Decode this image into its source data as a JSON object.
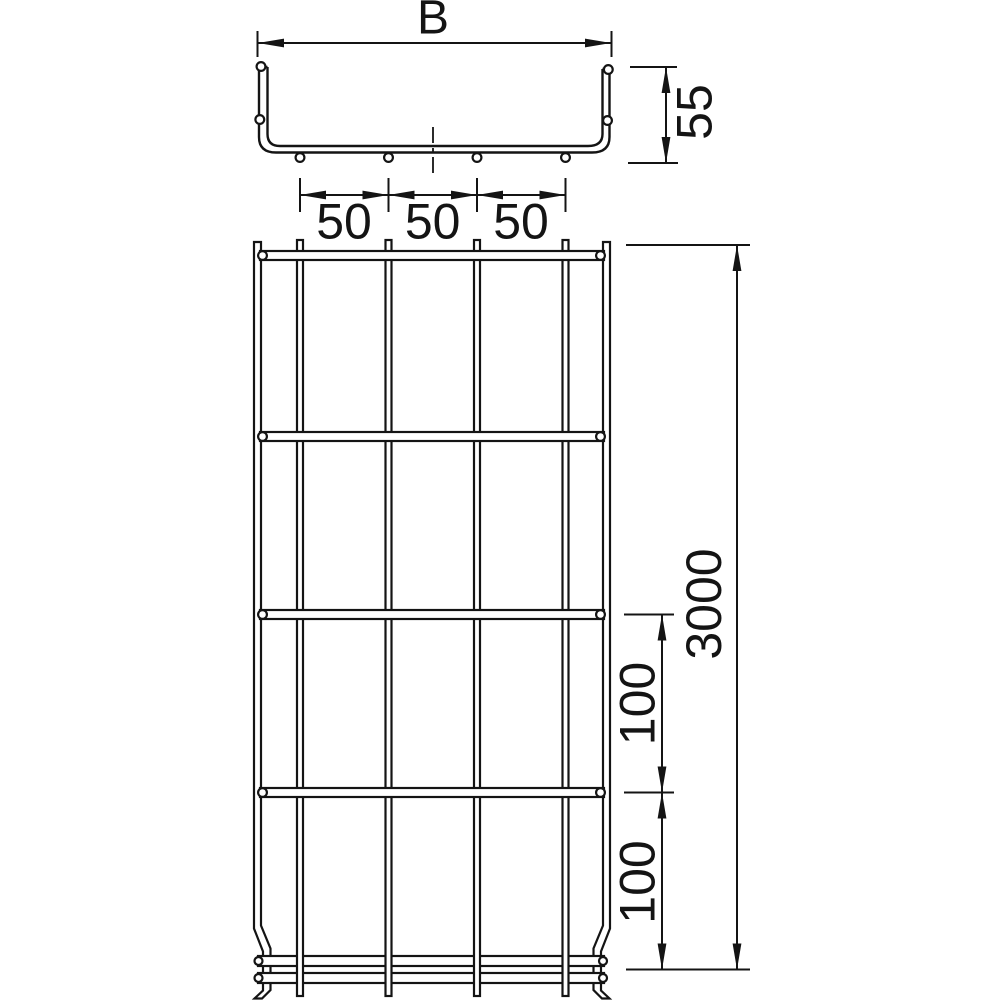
{
  "colors": {
    "line": "#141414",
    "background": "#ffffff"
  },
  "section_view": {
    "width_dim": "B",
    "height_dim": "55",
    "hole_spacing_dims": [
      "50",
      "50",
      "50"
    ]
  },
  "plan_view": {
    "length_dim": "3000",
    "rung_spacing_dims": [
      "100",
      "100"
    ]
  }
}
